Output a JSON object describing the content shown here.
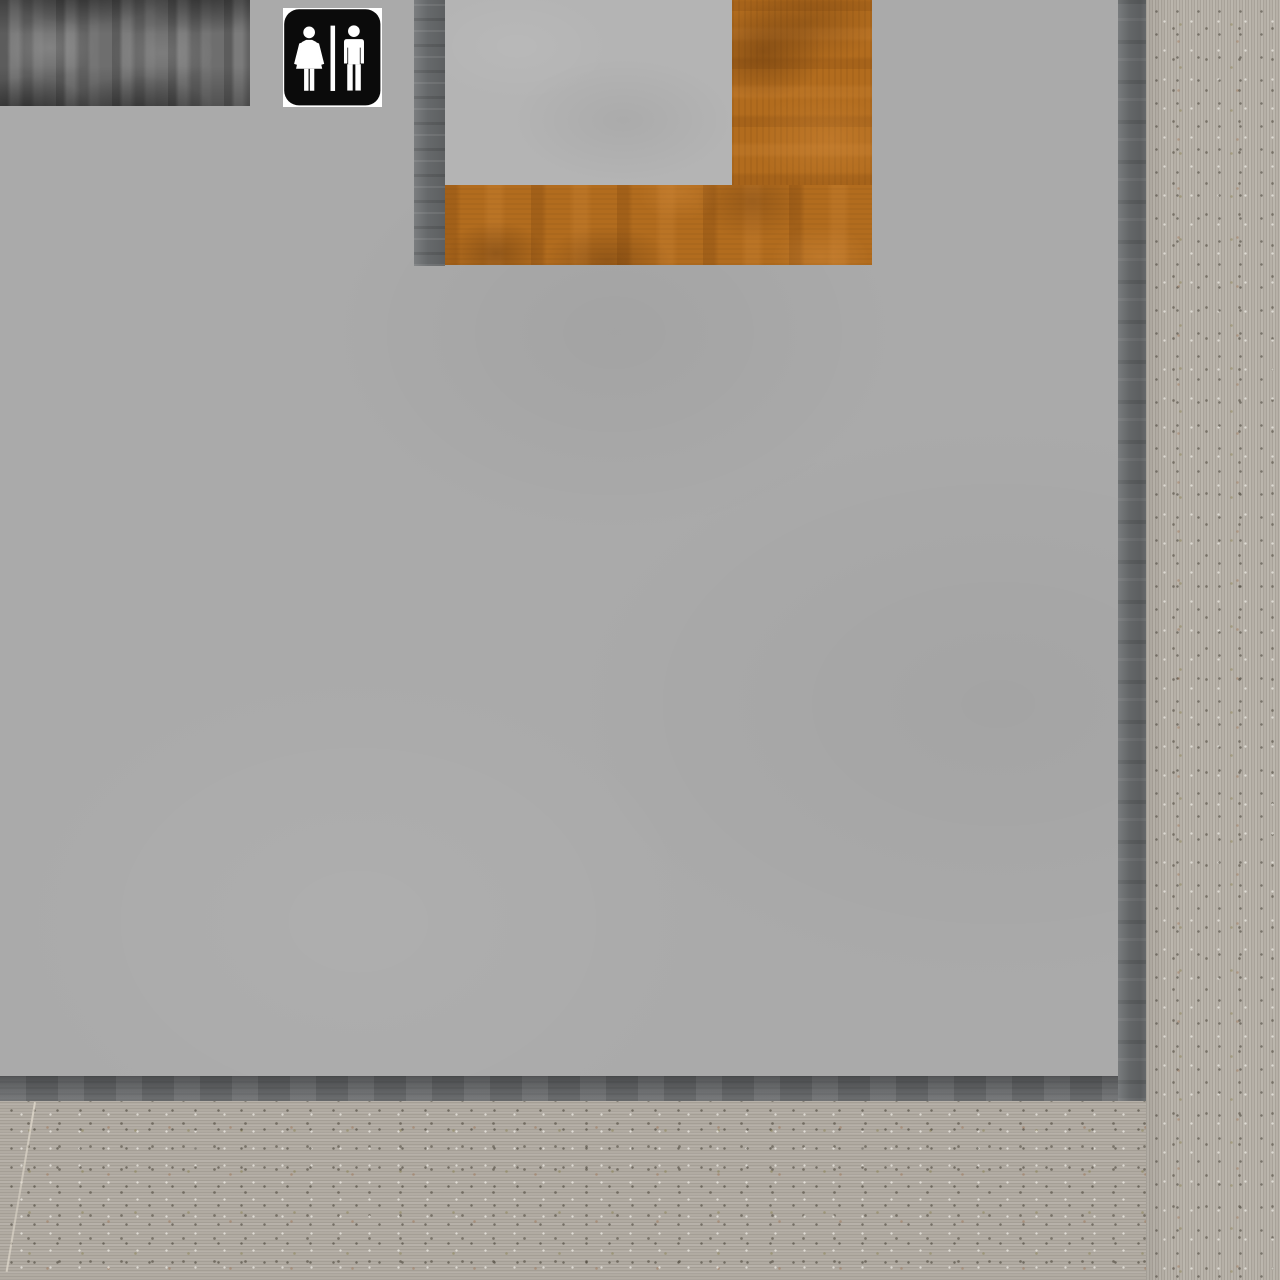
{
  "scene": {
    "kind": "3d-interior-render",
    "sign": {
      "label": "Restroom sign",
      "symbols": [
        "female-figure-icon",
        "divider-bar",
        "male-figure-icon"
      ]
    },
    "regions": [
      {
        "name": "dark-wood-panel"
      },
      {
        "name": "restroom-sign"
      },
      {
        "name": "wall-niche"
      },
      {
        "name": "wood-trim"
      },
      {
        "name": "gray-wall"
      },
      {
        "name": "baseboard"
      },
      {
        "name": "carpet-floor"
      },
      {
        "name": "concrete-column"
      },
      {
        "name": "carpet-seam"
      }
    ]
  },
  "colors": {
    "wall": "#aaaaaa",
    "alcove-panel": "#b4b4b4",
    "trim": "#6c6f71",
    "baseboard": "#67696b",
    "dark-wood": "#6e6e6e",
    "orange-wood": "#b26c1e",
    "orange-wood-dark": "#8a4f16",
    "orange-wood-light": "#cf8b33",
    "floor": "#b1aba2",
    "column": "#b6b0a7",
    "sign-bg": "#0b0b0b",
    "sign-fg": "#ffffff",
    "seam": "#ddd6c9"
  }
}
